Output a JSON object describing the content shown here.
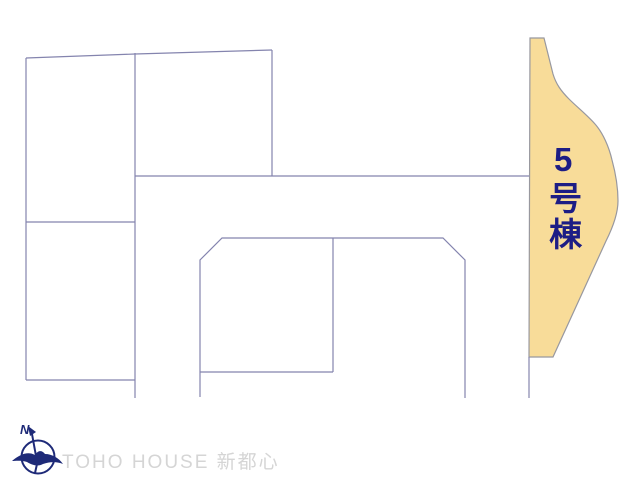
{
  "plan": {
    "background": "#ffffff",
    "line_color": "#8484ae",
    "lots": {
      "segments": [
        {
          "name": "top-boundary",
          "points": [
            [
              26,
              58
            ],
            [
              135,
              54
            ],
            [
              272,
              50
            ]
          ]
        },
        {
          "name": "left-block-west-edge",
          "points": [
            [
              26,
              58
            ],
            [
              26,
              380
            ]
          ]
        },
        {
          "name": "left-block-divider",
          "points": [
            [
              26,
              222
            ],
            [
              135,
              222
            ]
          ]
        },
        {
          "name": "left-block-bottom",
          "points": [
            [
              26,
              380
            ],
            [
              135,
              380
            ]
          ]
        },
        {
          "name": "vertical-x135",
          "points": [
            [
              135,
              53
            ],
            [
              135,
              398
            ]
          ]
        },
        {
          "name": "upper-right-east-edge",
          "points": [
            [
              272,
              50
            ],
            [
              272,
              176
            ]
          ]
        },
        {
          "name": "road-line",
          "points": [
            [
              135,
              176
            ],
            [
              529,
              176
            ]
          ]
        },
        {
          "name": "center-block-outline",
          "points": [
            [
              200,
              397
            ],
            [
              200,
              260
            ],
            [
              222,
              238
            ],
            [
              443,
              238
            ],
            [
              465,
              260
            ],
            [
              465,
              398
            ]
          ]
        },
        {
          "name": "center-block-divider",
          "points": [
            [
              333,
              238
            ],
            [
              333,
              372
            ]
          ]
        },
        {
          "name": "center-sub-bottom",
          "points": [
            [
              200,
              372
            ],
            [
              333,
              372
            ]
          ]
        },
        {
          "name": "east-edge-below-lot5",
          "points": [
            [
              529,
              357
            ],
            [
              529,
              398
            ]
          ]
        }
      ]
    },
    "highlight_lot": {
      "label": "5号棟",
      "fill": "#f8dc99",
      "stroke": "#98989f",
      "label_color": "#1d1d85",
      "path": "M530,38 L544,38 C547,50 550,62 553,74 C556,84 561,91 569,99 C577,107 587,115 595,124 C603,133 609,147 612,160 C615,171 618,187 618,201 C618,214 612,229 606,241 L553,357 L529,357 Z"
    },
    "compass": {
      "north_label": "N",
      "color": "#1e2a78"
    },
    "watermark": {
      "text": "TOHO HOUSE 新都心",
      "color": "#d5d5d5"
    }
  }
}
